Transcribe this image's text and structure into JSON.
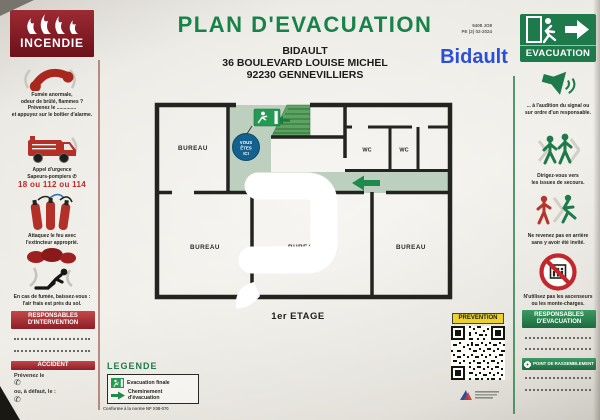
{
  "colors": {
    "title_green": "#17824a",
    "panel_green": "#1e7a4b",
    "pale_green": "#bdd0bf",
    "stair_green": "#5ca361",
    "dark_red": "#7e1822",
    "accent_red": "#c1272d",
    "marker_blue": "#13618e",
    "brand_blue": "#2b4fd7",
    "prevention_yellow": "#ecd22d"
  },
  "header": {
    "title": "PLAN D'EVACUATION",
    "site_name": "BIDAULT",
    "address_line1": "36 BOULEVARD LOUISE MICHEL",
    "address_line2": "92230 GENNEVILLIERS",
    "doc_ref_line1": "9408 JO8",
    "doc_ref_line2": "PE (2) 02-2024",
    "brand": "Bidault"
  },
  "incendie": {
    "title": "INCENDIE",
    "smoke_line1": "Fumée anormale,",
    "smoke_line2": "odeur de brûlé, flammes ?",
    "smoke_line3": "Prévenez le ..............",
    "smoke_line4": "et appuyez sur le boîtier d'alarme.",
    "call_line1": "Appel d'urgence",
    "call_line2": "Sapeurs-pompiers ✆",
    "call_numbers": "18 ou 112 ou 114",
    "extinguisher_line1": "Attaquez le feu avec",
    "extinguisher_line2": "l'extincteur approprié.",
    "crouch_line1": "En cas de fumée, baissez-vous :",
    "crouch_line2": "l'air frais est près du sol.",
    "responsables_title": "RESPONSABLES D'INTERVENTION",
    "accident_title": "ACCIDENT",
    "accident_line1": "Prévenez le",
    "accident_line2": "ou, à défaut, le :",
    "phone_glyph": "✆"
  },
  "evacuation": {
    "title": "EVACUATION",
    "signal_line1": "... à l'audition du signal ou",
    "signal_line2": "sur ordre d'un responsable.",
    "issues_line1": "Dirigez-vous vers",
    "issues_line2": "les issues de secours.",
    "retour_line1": "Ne revenez pas en arrière",
    "retour_line2": "sans y avoir été invité.",
    "ascenseur_line1": "N'utilisez pas les ascenseurs",
    "ascenseur_line2": "ou les monte-charges.",
    "responsables_title": "RESPONSABLES D'EVACUATION",
    "rassemblement_title": "POINT DE RASSEMBLEMENT"
  },
  "plan": {
    "room_top_left": "BUREAU",
    "room_bottom_left": "BUREAU",
    "room_bottom_middle": "BUREAU",
    "room_bottom_right": "BUREAU",
    "wc_left": "WC",
    "wc_right": "WC",
    "you_are_here_line1": "VOUS",
    "you_are_here_line2": "ÊTES",
    "you_are_here_line3": "ICI",
    "floor_label": "1er ETAGE"
  },
  "legend": {
    "title": "LEGENDE",
    "item1_label": "Evacuation finale",
    "item2_label": "Cheminement d'évacuation",
    "norm_note": "Conforme à la norme NF X08-070"
  },
  "prevention": {
    "title": "PREVENTION"
  }
}
